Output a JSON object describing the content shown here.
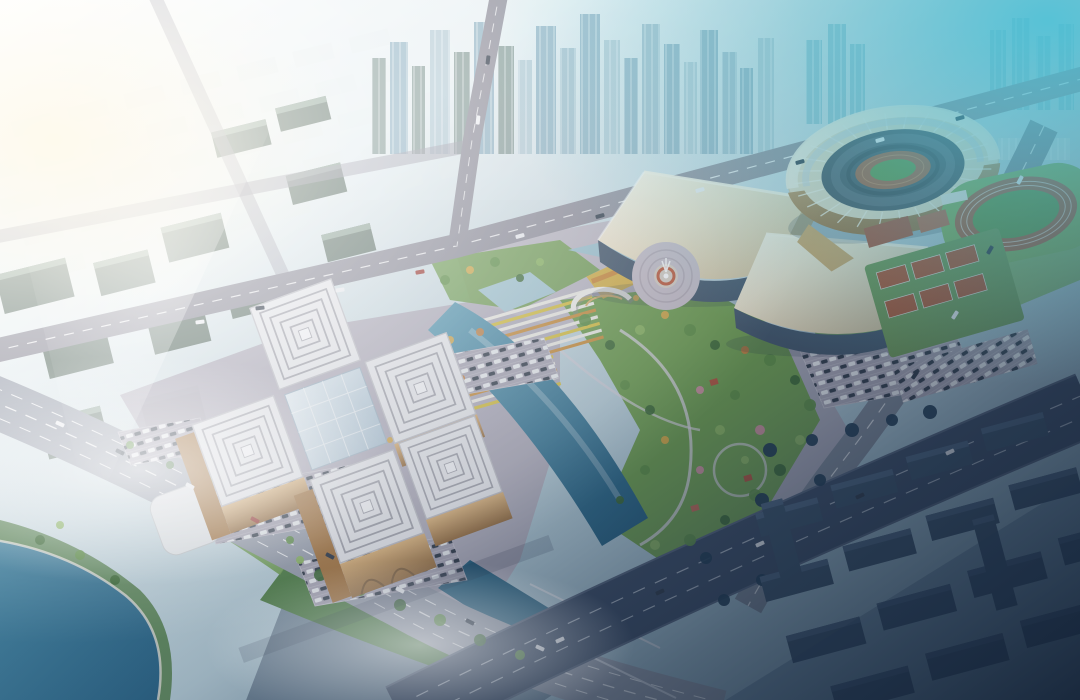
{
  "scene": {
    "type": "architectural-aerial-rendering",
    "description": "Aerial rendering of a riverside cultural and sports complex at dusk: an oval stadium with a practice athletics track, two wave-roofed exhibition halls around a circular fountain plaza, a museum of five maze-patterned square roofs with a glass core, landscaped park with crescent water features, striped flower beds, surface parking lots, diagonal highways with traffic, a dense high-rise skyline fading into white and cyan haze, and shaded residential blocks in blue fog in the foreground."
  },
  "landmarks": {
    "skyline": {
      "label": "high-rise-skyline-in-haze"
    },
    "low_rise_city": {
      "label": "low-rise-city-grid"
    },
    "left_blocks": {
      "label": "mid-rise-office-blocks"
    },
    "stadium": {
      "label": "oval-stadium-golden-facade"
    },
    "practice_track": {
      "label": "athletics-practice-track"
    },
    "exhibition_halls": {
      "label": "wave-roof-exhibition-halls"
    },
    "fountain_plaza": {
      "label": "circular-fountain-plaza"
    },
    "museum": {
      "label": "maze-roof-museum-complex"
    },
    "park": {
      "label": "riverside-landscaped-park"
    },
    "flower_beds": {
      "label": "striped-flower-beds"
    },
    "monument": {
      "label": "white-arc-monument"
    },
    "water": {
      "label": "crescent-water-features"
    },
    "lake": {
      "label": "southwest-lake"
    },
    "roads": {
      "label": "road-network"
    },
    "highway": {
      "label": "dark-diagonal-highway"
    },
    "parking": {
      "label": "surface-parking-lots"
    },
    "courts": {
      "label": "outdoor-sports-courts"
    },
    "residential": {
      "label": "foreground-residential-blocks-in-fog"
    },
    "traffic": {
      "label": "vehicles"
    },
    "trees": {
      "label": "tree-clusters"
    }
  },
  "palette": {
    "haze_white": "#f6fafb",
    "sky_blue": "#b9d2dd",
    "cyan_haze": "#55c2d6",
    "pavement": "#b2adbb",
    "pavement_dark": "#a09caa",
    "road_gray": "#8f8e9a",
    "road_dark": "#3b4a62",
    "park_green": "#6f9e4e",
    "park_green_dark": "#4f7f44",
    "lawn_green": "#7fae5a",
    "tree_dark": "#3d6a34",
    "water_teal": "#2f7494",
    "water_light": "#a5c8d4",
    "roof_cream": "#efe5cc",
    "roof_white": "#ebebee",
    "facade_gold": "#c79a63",
    "glass_dark": "#43566a",
    "track_red": "#a65c3c",
    "field_green": "#5d9544",
    "court_red": "#b2522e",
    "fog_navy": "#16243a",
    "block_navy": "#3a5066"
  }
}
